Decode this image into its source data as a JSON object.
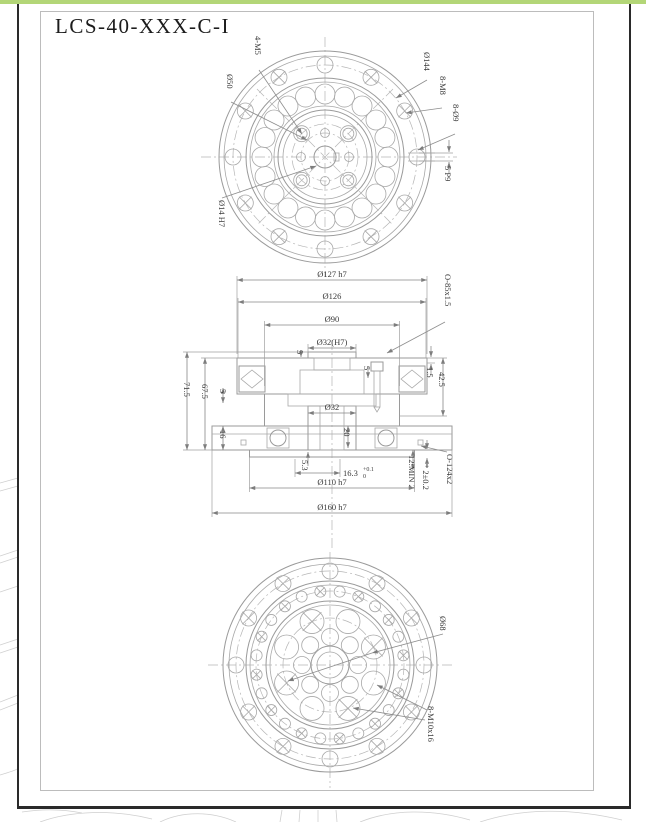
{
  "title": "LCS-40-XXX-C-I",
  "colors": {
    "accent_green": "#b3d677",
    "frame_black": "#2a2a2a",
    "sheet_border": "#bcbcbc",
    "drawing_line": "#9a9a9a",
    "dim_text": "#3a3a3a"
  },
  "top_view": {
    "label_4m5": "4-M5",
    "label_d50": "Ø50",
    "label_d144": "Ø144",
    "label_8m8": "8-M8",
    "label_8d9": "8-Ø9",
    "label_5p9": "5 P9",
    "label_d14h7": "Ø14 H7"
  },
  "section_view": {
    "d127h7": "Ø127 h7",
    "d126": "Ø126",
    "d90": "Ø90",
    "d32h7": "Ø32(H7)",
    "oring85": "O-85x1.5",
    "n1_5": "1.5",
    "n42_5": "42.5",
    "n71_5": "71.5",
    "n67_5": "67.5",
    "n5_left": "5",
    "n5_top": "5",
    "n5_mid": "5",
    "n16": "16",
    "d32": "Ø32",
    "n20": "20",
    "n5_3": "5.3",
    "n16_3": "16.3",
    "tol_up": "+0.1",
    "tol_dn": "0",
    "n2pm": "* 2±0.2",
    "nmin": "12:MIN 2",
    "oring124": "O-124x2",
    "d110h7": "Ø110 h7",
    "d160h7": "Ø160 h7"
  },
  "bottom_view": {
    "label_d68": "Ø68",
    "label_8m10": "8-M10x16"
  }
}
